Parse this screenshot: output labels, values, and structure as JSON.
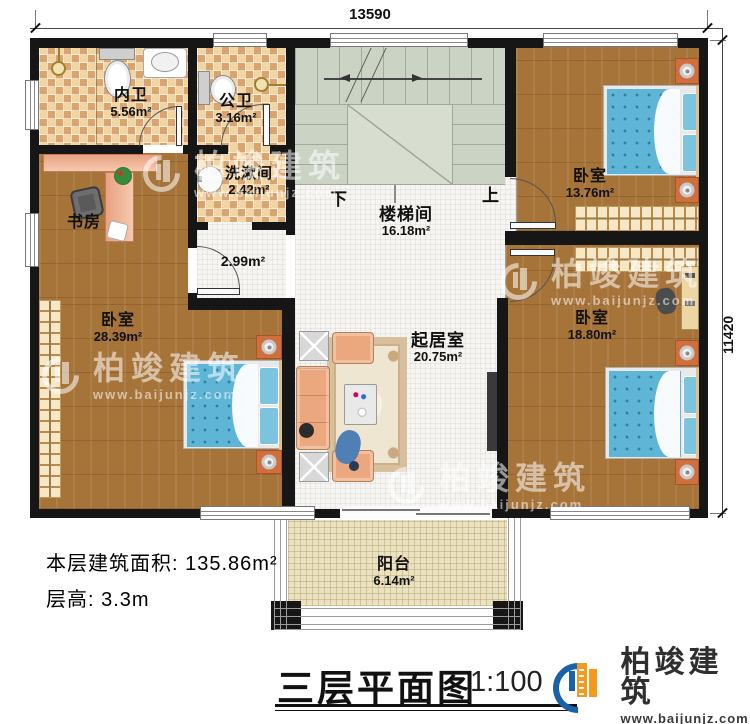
{
  "dimensions": {
    "width_top": "13590",
    "height_right": "11420"
  },
  "stairs": {
    "down": "下",
    "up": "上"
  },
  "rooms": {
    "inner_bath": {
      "name": "内卫",
      "area": "5.56m²"
    },
    "public_bath": {
      "name": "公卫",
      "area": "3.16m²"
    },
    "washroom": {
      "name": "洗漱间",
      "area": "2.42m²"
    },
    "hallway": {
      "area": "2.99m²"
    },
    "study": {
      "name": "书房"
    },
    "stairwell": {
      "name": "楼梯间",
      "area": "16.18m²"
    },
    "bedroom_left": {
      "name": "卧室",
      "area": "28.39m²"
    },
    "bedroom_top_right": {
      "name": "卧室",
      "area": "13.76m²"
    },
    "bedroom_bottom_right": {
      "name": "卧室",
      "area": "18.80m²"
    },
    "living_room": {
      "name": "起居室",
      "area": "20.75m²"
    },
    "balcony": {
      "name": "阳台",
      "area": "6.14m²"
    }
  },
  "info": {
    "floor_area_label": "本层建筑面积:",
    "floor_area_value": "135.86m²",
    "floor_height_label": "层高:",
    "floor_height_value": "3.3m"
  },
  "title": {
    "name": "三层平面图",
    "scale": "1:100"
  },
  "brand": {
    "name": "柏竣建筑",
    "url": "www.baijunjz.com"
  },
  "watermark": {
    "name": "柏竣建筑",
    "url": "www.baijunjz.com"
  },
  "colors": {
    "wall": "#161616",
    "wood": "#a67338",
    "tile": "#f0d6a2",
    "stair": "#cbd3c5",
    "bed_blue": "#5eb5d5",
    "brand_blue": "#1a62a8",
    "brand_orange": "#f29b1d"
  }
}
